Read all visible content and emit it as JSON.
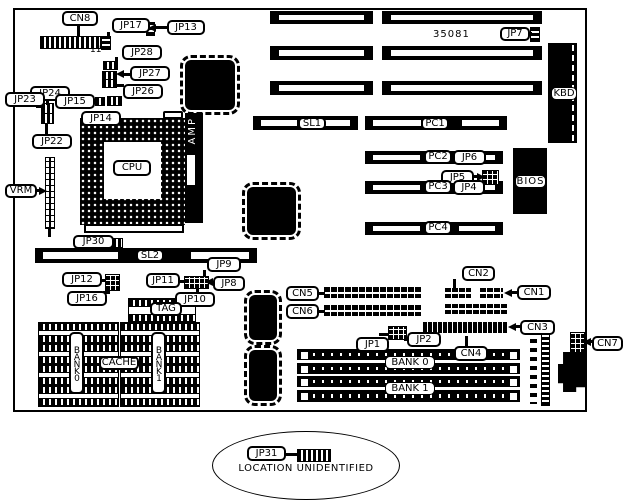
{
  "figure": {
    "part_number": "35081",
    "cn8_pin": "11",
    "chips": {
      "cpu": "CPU",
      "amp": "AMP",
      "bios": "BIOS",
      "tag": "TAG",
      "cache": "CACHE",
      "kbd": "KBD",
      "vrm": "VRM"
    },
    "slots": {
      "sl1": "SL1",
      "sl2": "SL2",
      "pc1": "PC1",
      "pc2": "PC2",
      "pc3": "PC3",
      "pc4": "PC4"
    },
    "jumpers": {
      "jp1": "JP1",
      "jp2": "JP2",
      "jp4": "JP4",
      "jp5": "JP5",
      "jp6": "JP6",
      "jp7": "JP7",
      "jp8": "JP8",
      "jp9": "JP9",
      "jp10": "JP10",
      "jp11": "JP11",
      "jp12": "JP12",
      "jp13": "JP13",
      "jp14": "JP14",
      "jp15": "JP15",
      "jp16": "JP16",
      "jp17": "JP17",
      "jp22": "JP22",
      "jp23": "JP23",
      "jp24": "JP24",
      "jp26": "JP26",
      "jp27": "JP27",
      "jp28": "JP28",
      "jp30": "JP30",
      "jp31": "JP31"
    },
    "connectors": {
      "cn1": "CN1",
      "cn2": "CN2",
      "cn3": "CN3",
      "cn4": "CN4",
      "cn5": "CN5",
      "cn6": "CN6",
      "cn7": "CN7",
      "cn8": "CN8"
    },
    "cache_banks": {
      "bank0": "BANK0",
      "bank1": "BANK1"
    },
    "memory_banks": {
      "bank0": "BANK 0",
      "bank1": "BANK 1"
    },
    "note": {
      "jumper": "JP31",
      "text": "LOCATION UNIDENTIFIED"
    }
  }
}
